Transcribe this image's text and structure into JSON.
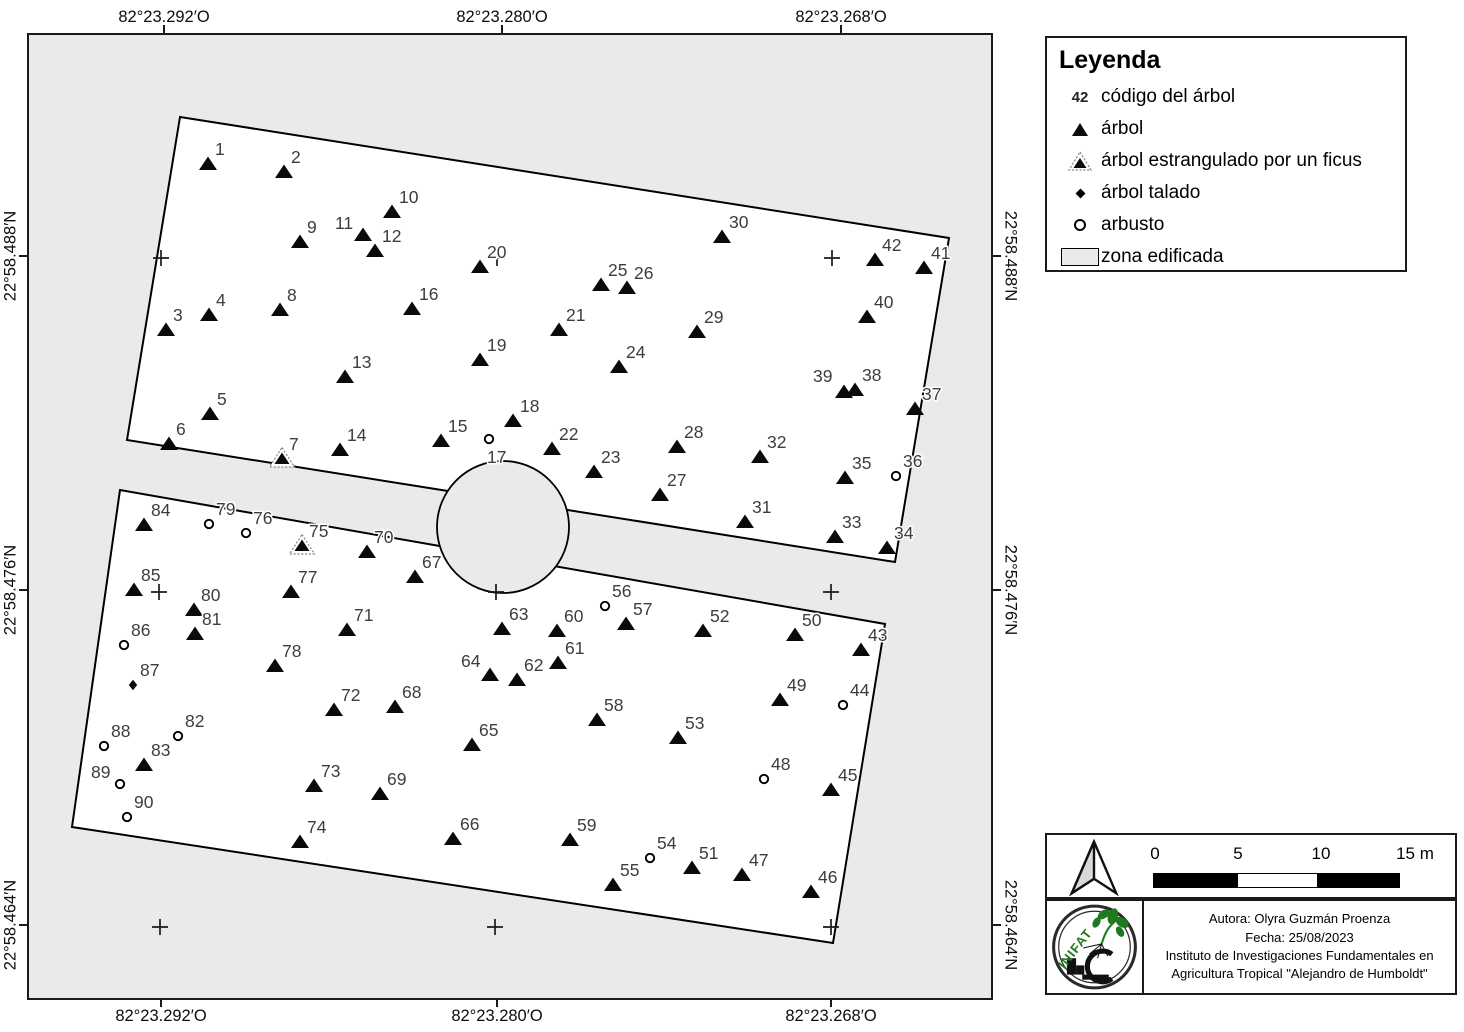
{
  "axes": {
    "top": [
      "82°23.292′O",
      "82°23.280′O",
      "82°23.268′O"
    ],
    "bottom": [
      "82°23.292′O",
      "82°23.280′O",
      "82°23.268′O"
    ],
    "left": [
      "22°58.488′N",
      "22°58.476′N",
      "22°58.464′N"
    ],
    "right": [
      "22°58.488′N",
      "22°58.476′N",
      "22°58.464′N"
    ]
  },
  "legend": {
    "title": "Leyenda",
    "items": [
      {
        "symbol": "code",
        "symbol_text": "42",
        "label": "código del árbol"
      },
      {
        "symbol": "triangle",
        "label": "árbol"
      },
      {
        "symbol": "strangled",
        "label": "árbol estrangulado por un ficus"
      },
      {
        "symbol": "diamond",
        "label": "árbol talado"
      },
      {
        "symbol": "circle",
        "label": "arbusto"
      },
      {
        "symbol": "area",
        "label": "zona edificada"
      }
    ]
  },
  "scalebar": {
    "labels": [
      "0",
      "5",
      "10",
      "15 m"
    ]
  },
  "credits": {
    "logo_text": "INIFAT",
    "line1": "Autora: Olyra Guzmán Proenza",
    "line2": "Fecha: 25/08/2023",
    "line3": "Instituto de Investigaciones Fundamentales en",
    "line4": "Agricultura Tropical \"Alejandro de Humboldt\""
  },
  "map": {
    "colors": {
      "built_zone": "#eaeaea",
      "plot_fill": "#ffffff",
      "outline": "#000000",
      "marker": "#0a0a0a",
      "point_label": "#3d3d3d",
      "logo_green": "#1e7a1e"
    },
    "polygons": {
      "upper": [
        [
          151,
          82
        ],
        [
          920,
          203
        ],
        [
          866,
          527
        ],
        [
          98,
          405
        ]
      ],
      "lower": [
        [
          91,
          455
        ],
        [
          856,
          589
        ],
        [
          804,
          908
        ],
        [
          43,
          792
        ]
      ]
    },
    "building_circle": {
      "cx": 474,
      "cy": 492,
      "r": 66
    },
    "crosses": [
      [
        132,
        223
      ],
      [
        468,
        223
      ],
      [
        803,
        223
      ],
      [
        130,
        557
      ],
      [
        467,
        557
      ],
      [
        802,
        557
      ],
      [
        131,
        892
      ],
      [
        466,
        892
      ],
      [
        802,
        892
      ]
    ],
    "marker_types": {
      "t": "árbol",
      "s": "árbol estrangulado por un ficus",
      "d": "árbol talado",
      "c": "arbusto"
    },
    "points": [
      {
        "n": "1",
        "x": 179,
        "y": 129,
        "t": "t"
      },
      {
        "n": "2",
        "x": 255,
        "y": 137,
        "t": "t"
      },
      {
        "n": "3",
        "x": 137,
        "y": 295,
        "t": "t"
      },
      {
        "n": "4",
        "x": 180,
        "y": 280,
        "t": "t"
      },
      {
        "n": "5",
        "x": 181,
        "y": 379,
        "t": "t"
      },
      {
        "n": "6",
        "x": 140,
        "y": 409,
        "t": "t"
      },
      {
        "n": "7",
        "x": 253,
        "y": 424,
        "t": "s"
      },
      {
        "n": "8",
        "x": 251,
        "y": 275,
        "t": "t"
      },
      {
        "n": "9",
        "x": 271,
        "y": 207,
        "t": "t"
      },
      {
        "n": "10",
        "x": 363,
        "y": 177,
        "t": "t"
      },
      {
        "n": "11",
        "x": 334,
        "y": 200,
        "t": "t",
        "dx": -28,
        "dy": -6
      },
      {
        "n": "12",
        "x": 346,
        "y": 216,
        "t": "t"
      },
      {
        "n": "13",
        "x": 316,
        "y": 342,
        "t": "t"
      },
      {
        "n": "14",
        "x": 311,
        "y": 415,
        "t": "t"
      },
      {
        "n": "15",
        "x": 412,
        "y": 406,
        "t": "t"
      },
      {
        "n": "16",
        "x": 383,
        "y": 274,
        "t": "t"
      },
      {
        "n": "17",
        "x": 460,
        "y": 404,
        "t": "c",
        "dx": -2,
        "dy": 24
      },
      {
        "n": "18",
        "x": 484,
        "y": 386,
        "t": "t"
      },
      {
        "n": "19",
        "x": 451,
        "y": 325,
        "t": "t"
      },
      {
        "n": "20",
        "x": 451,
        "y": 232,
        "t": "t"
      },
      {
        "n": "21",
        "x": 530,
        "y": 295,
        "t": "t"
      },
      {
        "n": "22",
        "x": 523,
        "y": 414,
        "t": "t"
      },
      {
        "n": "23",
        "x": 565,
        "y": 437,
        "t": "t"
      },
      {
        "n": "24",
        "x": 590,
        "y": 332,
        "t": "t"
      },
      {
        "n": "25",
        "x": 572,
        "y": 250,
        "t": "t"
      },
      {
        "n": "26",
        "x": 598,
        "y": 253,
        "t": "t"
      },
      {
        "n": "27",
        "x": 631,
        "y": 460,
        "t": "t"
      },
      {
        "n": "28",
        "x": 648,
        "y": 412,
        "t": "t"
      },
      {
        "n": "29",
        "x": 668,
        "y": 297,
        "t": "t"
      },
      {
        "n": "30",
        "x": 693,
        "y": 202,
        "t": "t"
      },
      {
        "n": "31",
        "x": 716,
        "y": 487,
        "t": "t"
      },
      {
        "n": "32",
        "x": 731,
        "y": 422,
        "t": "t"
      },
      {
        "n": "33",
        "x": 806,
        "y": 502,
        "t": "t"
      },
      {
        "n": "34",
        "x": 858,
        "y": 513,
        "t": "t"
      },
      {
        "n": "35",
        "x": 816,
        "y": 443,
        "t": "t"
      },
      {
        "n": "36",
        "x": 867,
        "y": 441,
        "t": "c"
      },
      {
        "n": "37",
        "x": 886,
        "y": 374,
        "t": "t"
      },
      {
        "n": "38",
        "x": 826,
        "y": 355,
        "t": "t"
      },
      {
        "n": "39",
        "x": 815,
        "y": 357,
        "t": "t",
        "dx": -31,
        "dy": -10
      },
      {
        "n": "40",
        "x": 838,
        "y": 282,
        "t": "t"
      },
      {
        "n": "41",
        "x": 895,
        "y": 233,
        "t": "t"
      },
      {
        "n": "42",
        "x": 846,
        "y": 225,
        "t": "t"
      },
      {
        "n": "43",
        "x": 832,
        "y": 615,
        "t": "t"
      },
      {
        "n": "44",
        "x": 814,
        "y": 670,
        "t": "c"
      },
      {
        "n": "45",
        "x": 802,
        "y": 755,
        "t": "t"
      },
      {
        "n": "46",
        "x": 782,
        "y": 857,
        "t": "t"
      },
      {
        "n": "47",
        "x": 713,
        "y": 840,
        "t": "t"
      },
      {
        "n": "48",
        "x": 735,
        "y": 744,
        "t": "c"
      },
      {
        "n": "49",
        "x": 751,
        "y": 665,
        "t": "t"
      },
      {
        "n": "50",
        "x": 766,
        "y": 600,
        "t": "t"
      },
      {
        "n": "51",
        "x": 663,
        "y": 833,
        "t": "t"
      },
      {
        "n": "52",
        "x": 674,
        "y": 596,
        "t": "t"
      },
      {
        "n": "53",
        "x": 649,
        "y": 703,
        "t": "t"
      },
      {
        "n": "54",
        "x": 621,
        "y": 823,
        "t": "c"
      },
      {
        "n": "55",
        "x": 584,
        "y": 850,
        "t": "t"
      },
      {
        "n": "56",
        "x": 576,
        "y": 571,
        "t": "c"
      },
      {
        "n": "57",
        "x": 597,
        "y": 589,
        "t": "t"
      },
      {
        "n": "58",
        "x": 568,
        "y": 685,
        "t": "t"
      },
      {
        "n": "59",
        "x": 541,
        "y": 805,
        "t": "t"
      },
      {
        "n": "60",
        "x": 528,
        "y": 596,
        "t": "t"
      },
      {
        "n": "61",
        "x": 529,
        "y": 628,
        "t": "t"
      },
      {
        "n": "62",
        "x": 488,
        "y": 645,
        "t": "t"
      },
      {
        "n": "63",
        "x": 473,
        "y": 594,
        "t": "t"
      },
      {
        "n": "64",
        "x": 461,
        "y": 640,
        "t": "t",
        "dx": -29,
        "dy": -8
      },
      {
        "n": "65",
        "x": 443,
        "y": 710,
        "t": "t"
      },
      {
        "n": "66",
        "x": 424,
        "y": 804,
        "t": "t"
      },
      {
        "n": "67",
        "x": 386,
        "y": 542,
        "t": "t"
      },
      {
        "n": "68",
        "x": 366,
        "y": 672,
        "t": "t"
      },
      {
        "n": "69",
        "x": 351,
        "y": 759,
        "t": "t"
      },
      {
        "n": "70",
        "x": 338,
        "y": 517,
        "t": "t"
      },
      {
        "n": "71",
        "x": 318,
        "y": 595,
        "t": "t"
      },
      {
        "n": "72",
        "x": 305,
        "y": 675,
        "t": "t"
      },
      {
        "n": "73",
        "x": 285,
        "y": 751,
        "t": "t"
      },
      {
        "n": "74",
        "x": 271,
        "y": 807,
        "t": "t"
      },
      {
        "n": "75",
        "x": 273,
        "y": 511,
        "t": "s"
      },
      {
        "n": "76",
        "x": 217,
        "y": 498,
        "t": "c"
      },
      {
        "n": "77",
        "x": 262,
        "y": 557,
        "t": "t"
      },
      {
        "n": "78",
        "x": 246,
        "y": 631,
        "t": "t"
      },
      {
        "n": "79",
        "x": 180,
        "y": 489,
        "t": "c"
      },
      {
        "n": "80",
        "x": 165,
        "y": 575,
        "t": "t"
      },
      {
        "n": "81",
        "x": 166,
        "y": 599,
        "t": "t"
      },
      {
        "n": "82",
        "x": 149,
        "y": 701,
        "t": "c"
      },
      {
        "n": "83",
        "x": 115,
        "y": 730,
        "t": "t"
      },
      {
        "n": "84",
        "x": 115,
        "y": 490,
        "t": "t"
      },
      {
        "n": "85",
        "x": 105,
        "y": 555,
        "t": "t"
      },
      {
        "n": "86",
        "x": 95,
        "y": 610,
        "t": "c"
      },
      {
        "n": "87",
        "x": 104,
        "y": 650,
        "t": "d"
      },
      {
        "n": "88",
        "x": 75,
        "y": 711,
        "t": "c"
      },
      {
        "n": "89",
        "x": 91,
        "y": 749,
        "t": "c",
        "dx": -29,
        "dy": -6
      },
      {
        "n": "90",
        "x": 98,
        "y": 782,
        "t": "c"
      }
    ]
  }
}
